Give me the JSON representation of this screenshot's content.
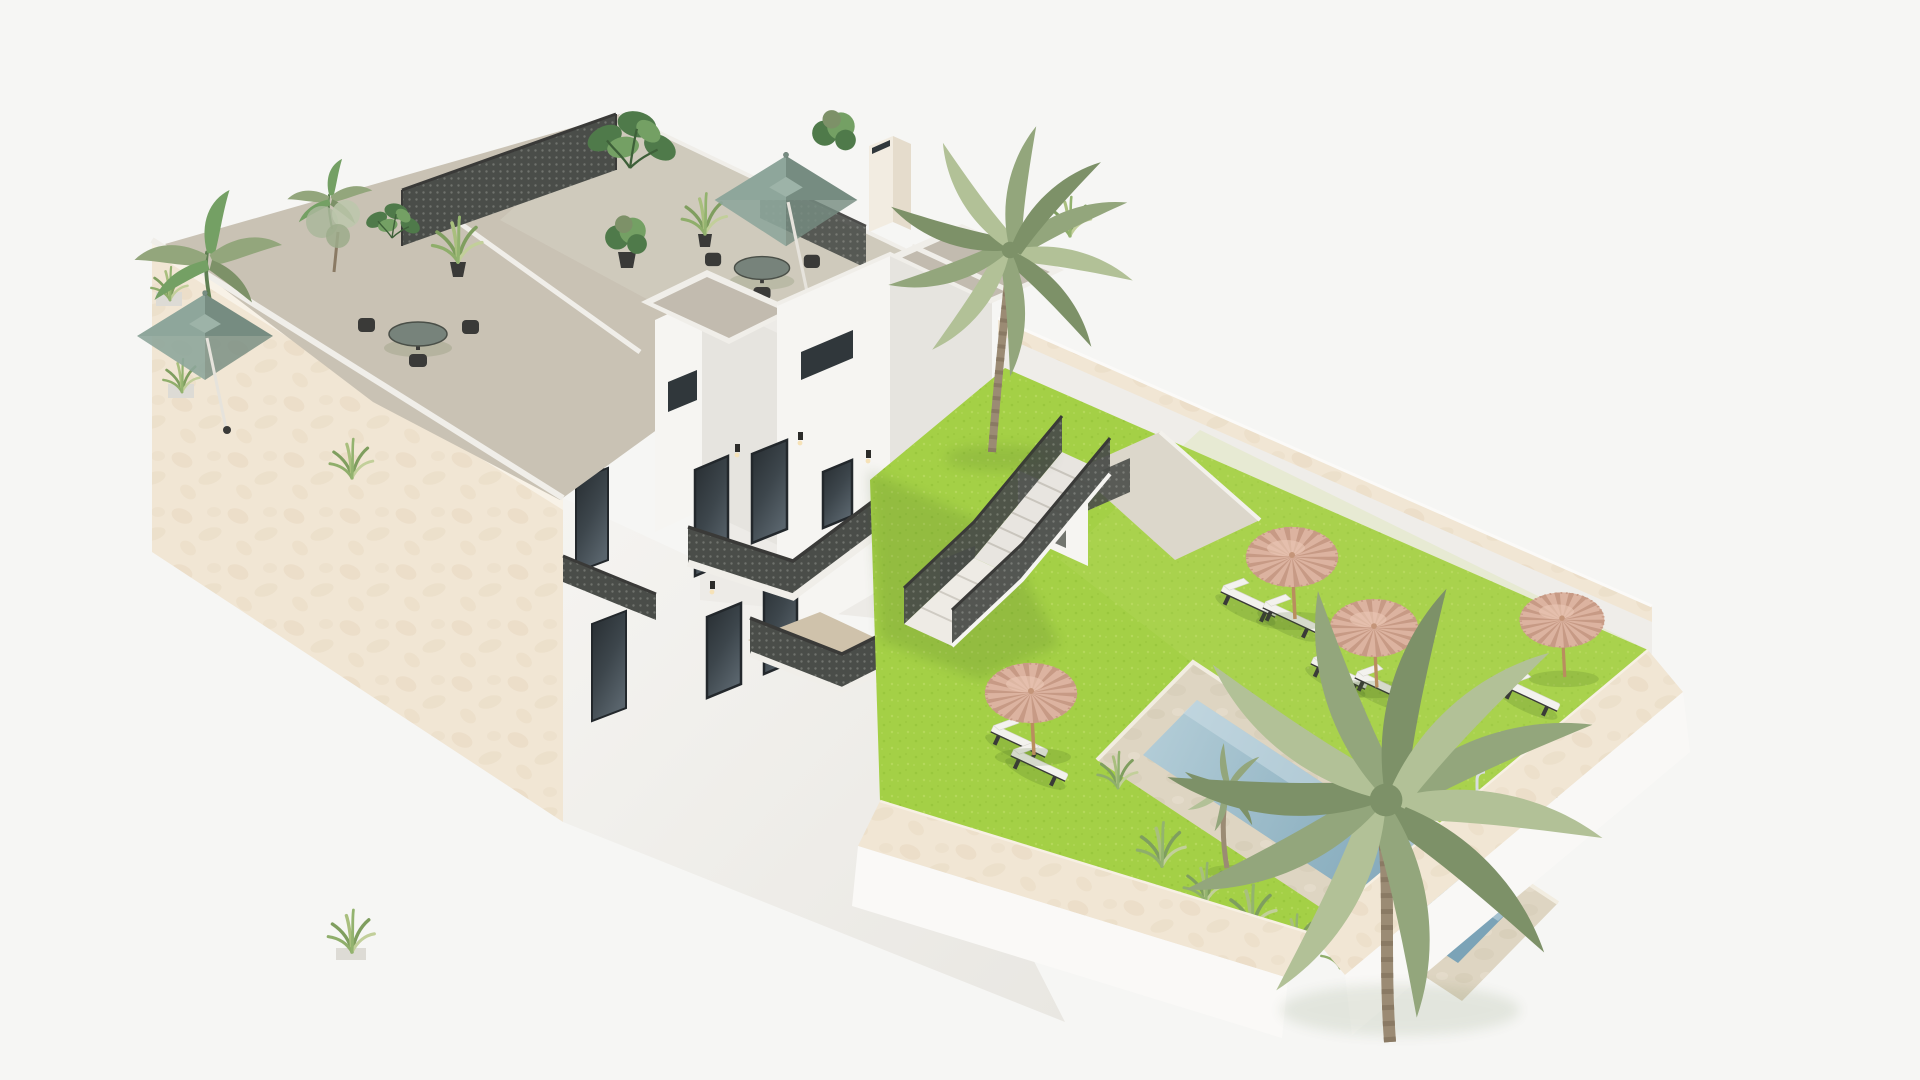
{
  "scene": {
    "title": "3D architectural rendering of a Mediterranean apartment complex with roof terraces and pool garden",
    "description": "Aerial 3D render on a white background: a white and beige stucco residential building with roof terraces (sage-green square umbrellas, dining sets, tropical plants, lattice screens, chimney, stair towers), exterior staircases with dark mesh railings, and a walled garden with bright artificial-grass lawn, a rectangular swimming pool with stone surround, ladder and entry step, four straw thatch umbrellas, eight white sun loungers and palm trees."
  },
  "colors": {
    "background": "#f6f6f4",
    "wall_white_lit": "#f6f5f2",
    "wall_white": "#edebe7",
    "wall_white_shade": "#e6e4df",
    "wall_white_dark": "#dddbd5",
    "wall_beige": "#f1e6d4",
    "wall_beige_shade": "#e6d6bd",
    "terrace_floor": "#c9c2b4",
    "terrace_floor_light": "#d4cec1",
    "roof_slab": "#c2bbaf",
    "lawn": "#a4d046",
    "lawn_dark": "#8fbe34",
    "lawn_light": "#c3e06d",
    "pool_water_light": "#b6cfd9",
    "pool_water_deep": "#7ba3b7",
    "pool_border": "#ded5c2",
    "mesh_dark": "#4a4d49",
    "mesh_dot": "#6f726d",
    "thatch": "#dcb3a0",
    "thatch_dark": "#c79a85",
    "sage": "#8ea69b",
    "sage_dark": "#768c81",
    "lounger_white": "#f3f2ee",
    "frame_dark": "#3a3a38",
    "palm_green": "#93a67c",
    "palm_green_light": "#b2c197",
    "palm_green_dark": "#7d9168",
    "palm_trunk": "#a18c75",
    "glass_dark": "#30373b",
    "glass_light": "#5a666e",
    "plant_green": "#4f7a4a",
    "plant_green_light": "#74a064",
    "shadow_green": "#3e5c22",
    "stone_white": "#f0eee9",
    "pole_wood": "#b98d5f"
  },
  "objects": {
    "building": {
      "label": "white residential building with roof terraces",
      "stair_towers": 2,
      "roof_umbrellas_sage": 2,
      "dining_sets": 2,
      "lattice_screens": 2,
      "chimneys": 1,
      "pergola_roofs": 1,
      "balcony_railings": "dark perforated mesh",
      "exterior_staircase_flights": 2
    },
    "garden": {
      "lawn": "bright artificial grass",
      "pool": {
        "shape": "rectangular",
        "ladders": 1,
        "entry_steps": 1,
        "surround": "light stone"
      },
      "thatch_umbrellas": 4,
      "sun_loungers": 8,
      "palm_trees_large": 2,
      "palm_trees_small": 1,
      "shrub_clusters": 6,
      "perimeter_walls": "beige stucco with white outer faces"
    }
  }
}
